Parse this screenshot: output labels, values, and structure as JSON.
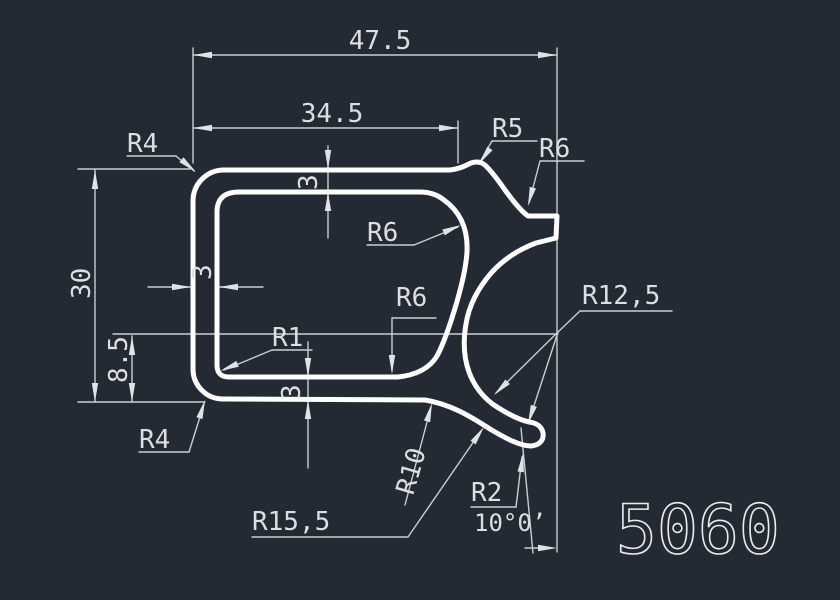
{
  "drawing": {
    "part_number": "5060",
    "dimensions": {
      "overall_width": "47.5",
      "inner_width": "34.5",
      "overall_height": "30",
      "bottom_offset": "8.5",
      "wall_left": "3",
      "wall_top": "3",
      "wall_bottom": "3",
      "lip_angle": "10°0’"
    },
    "radii": {
      "r4_top_left": "R4",
      "r5_crest": "R5",
      "r6_top_right": "R6",
      "r6_cavity_upper": "R6",
      "r6_cavity_lower": "R6",
      "r1_inner_corner": "R1",
      "r4_bottom_left": "R4",
      "r10_leg": "R10",
      "r12_5_bowl": "R12,5",
      "r15_5_sweep": "R15,5",
      "r2_hook_tip": "R2"
    },
    "colors": {
      "background": "#242a33",
      "profile_line": "#ffffff",
      "dimension_line": "#c9ced3",
      "text": "#dcdfe2"
    }
  }
}
